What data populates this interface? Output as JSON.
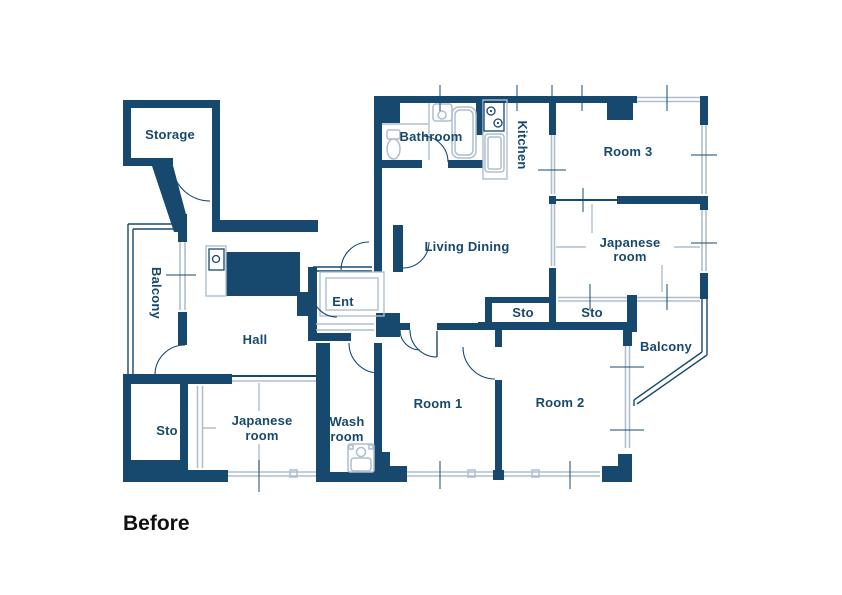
{
  "caption": "Before",
  "colors": {
    "wall": "#17496e",
    "window": "#aebecf",
    "caption": "#111111",
    "background": "#ffffff"
  },
  "labels": {
    "storage": "Storage",
    "balcony_left": "Balcony",
    "hall": "Hall",
    "ent": "Ent",
    "bathroom": "Bathroom",
    "kitchen": "Kitchen",
    "living_dining": "Living Dining",
    "room3": "Room 3",
    "japanese_right_line1": "Japanese",
    "japanese_right_line2": "room",
    "sto_mid_left": "Sto",
    "sto_mid_right": "Sto",
    "balcony_right": "Balcony",
    "room1": "Room 1",
    "room2": "Room 2",
    "wash_line1": "Wash",
    "wash_line2": "room",
    "japanese_bottom_line1": "Japanese",
    "japanese_bottom_line2": "room",
    "sto_bottom_left": "Sto"
  }
}
